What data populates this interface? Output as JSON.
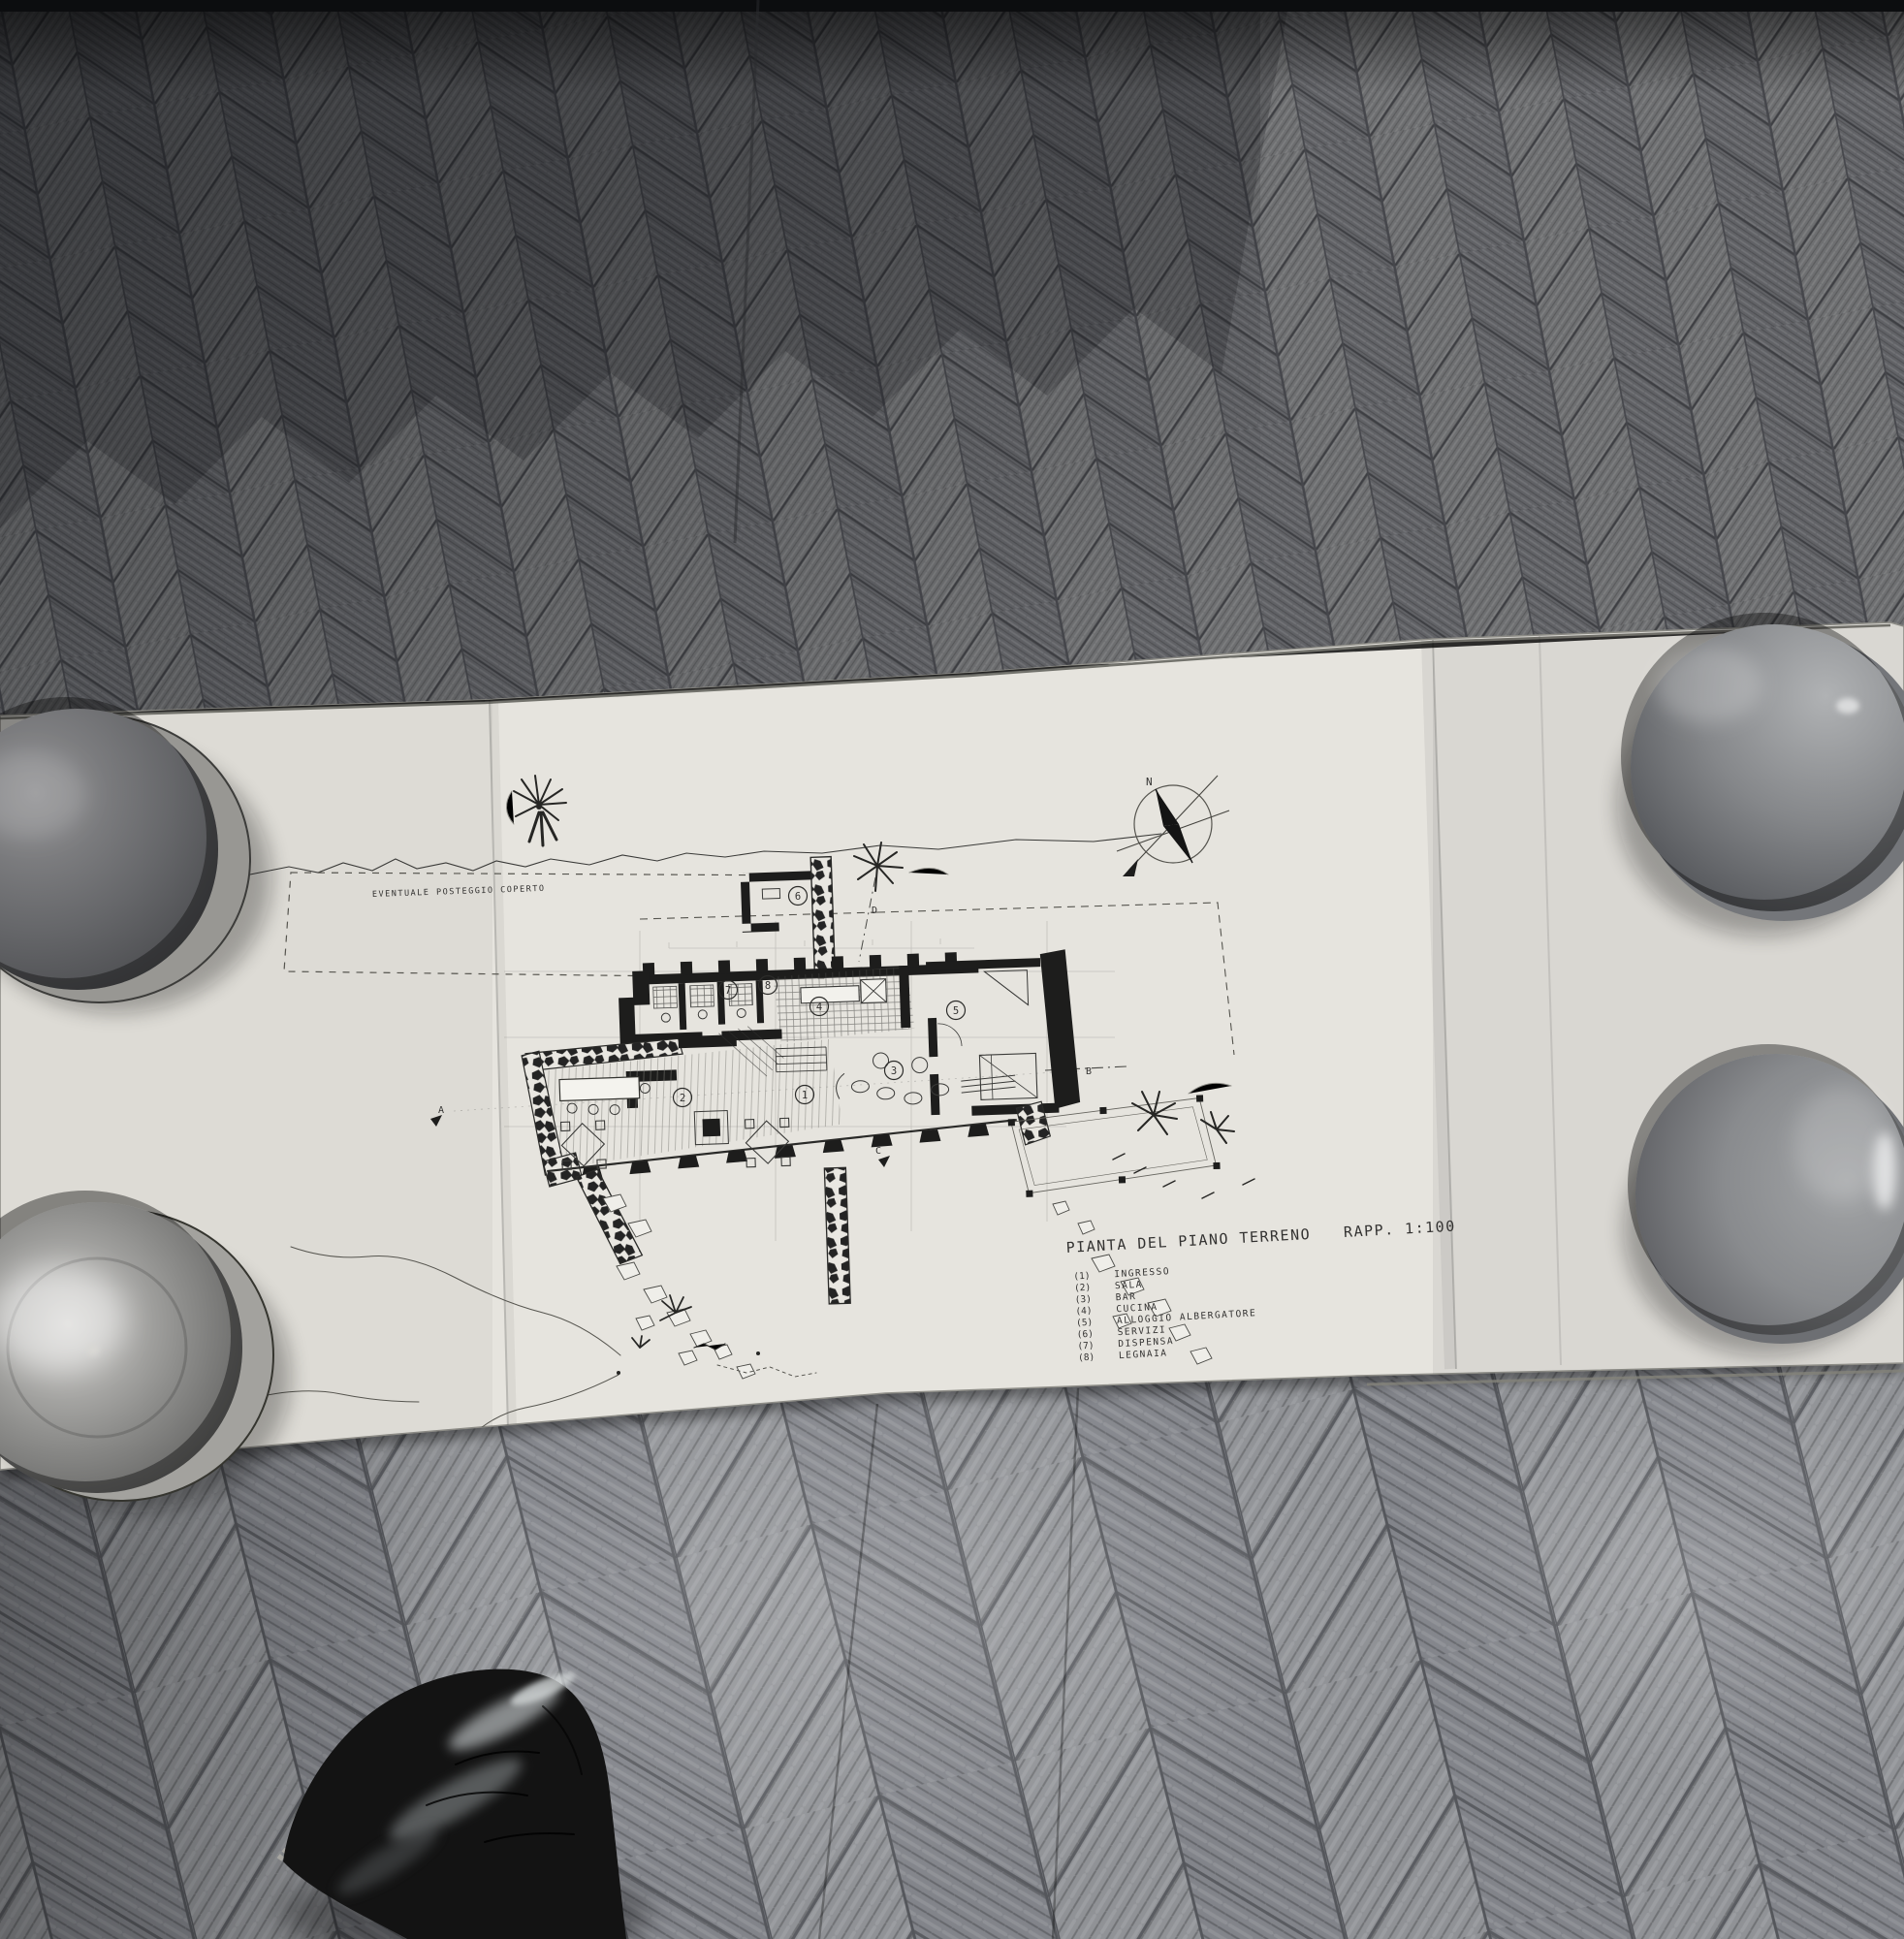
{
  "drawing": {
    "title": "PIANTA DEL PIANO TERRENO",
    "scale_label": "RAPP. 1:100",
    "site_note": "EVENTUALE POSTEGGIO COPERTO",
    "compass_label": "N",
    "section_markers": [
      "A",
      "B",
      "C",
      "D"
    ],
    "room_numbers": [
      "1",
      "2",
      "3",
      "4",
      "5",
      "6",
      "7",
      "8"
    ],
    "legend": {
      "items": [
        {
          "num": "(1)",
          "label": "INGRESSO"
        },
        {
          "num": "(2)",
          "label": "SALA"
        },
        {
          "num": "(3)",
          "label": "BAR"
        },
        {
          "num": "(4)",
          "label": "CUCINA"
        },
        {
          "num": "(5)",
          "label": "ALLOGGIO ALBERGATORE"
        },
        {
          "num": "(6)",
          "label": "SERVIZI"
        },
        {
          "num": "(7)",
          "label": "DISPENSA"
        },
        {
          "num": "(8)",
          "label": "LEGNAIA"
        }
      ]
    }
  },
  "colors": {
    "floor_plank": "#66676b",
    "floor_dark": "#3c3e42",
    "floor_light": "#8f9296",
    "paper": "#e6e4de",
    "ink": "#3a3a38",
    "wall_poche": "#1d1d1c",
    "bowl_gray": "#8a8c8e",
    "shoe_black": "#131313"
  }
}
